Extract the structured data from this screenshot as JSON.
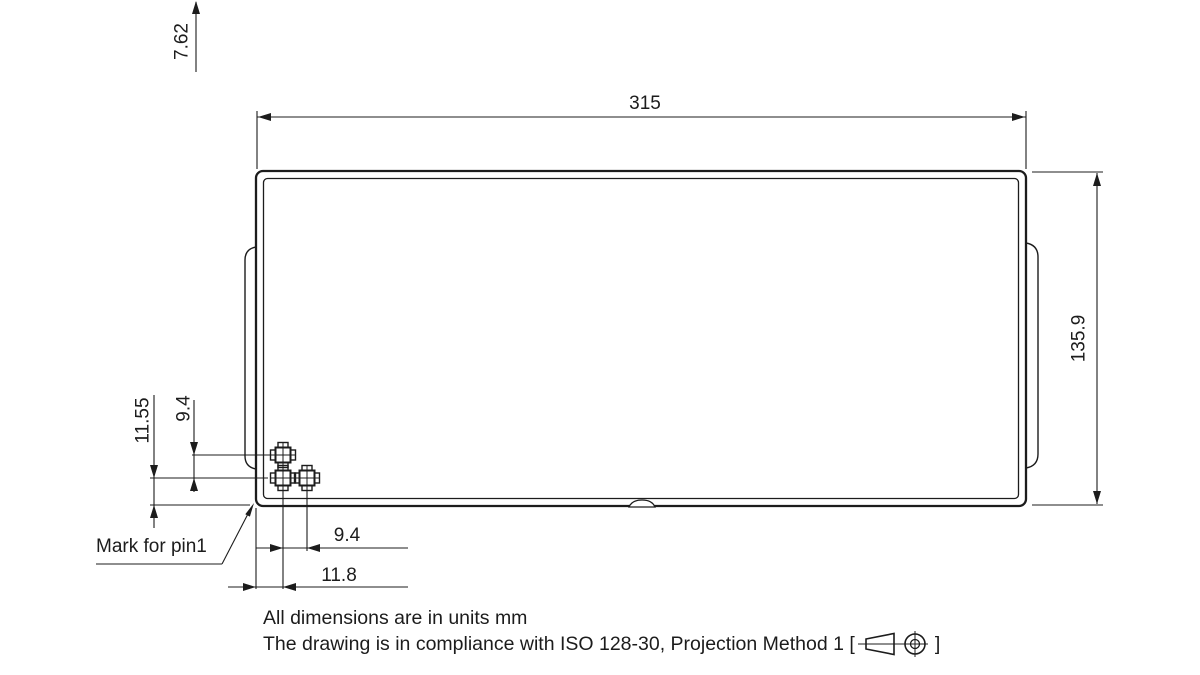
{
  "drawing": {
    "dims": {
      "top_pitch": "7.62",
      "body_width": "315",
      "body_height": "135.9",
      "pin_bottom_offset": "11.55",
      "pin_row_spacing": "9.4",
      "pin_col_spacing": "9.4",
      "pin_left_offset": "11.8"
    },
    "callouts": {
      "pin1": "Mark for pin1"
    },
    "notes": {
      "units": "All dimensions are in units mm",
      "standard_prefix": "The drawing is in compliance with ISO 128-30, Projection Method 1 [",
      "standard_suffix": "]"
    },
    "colors": {
      "ink": "#1c1c1c",
      "background": "#ffffff"
    }
  }
}
